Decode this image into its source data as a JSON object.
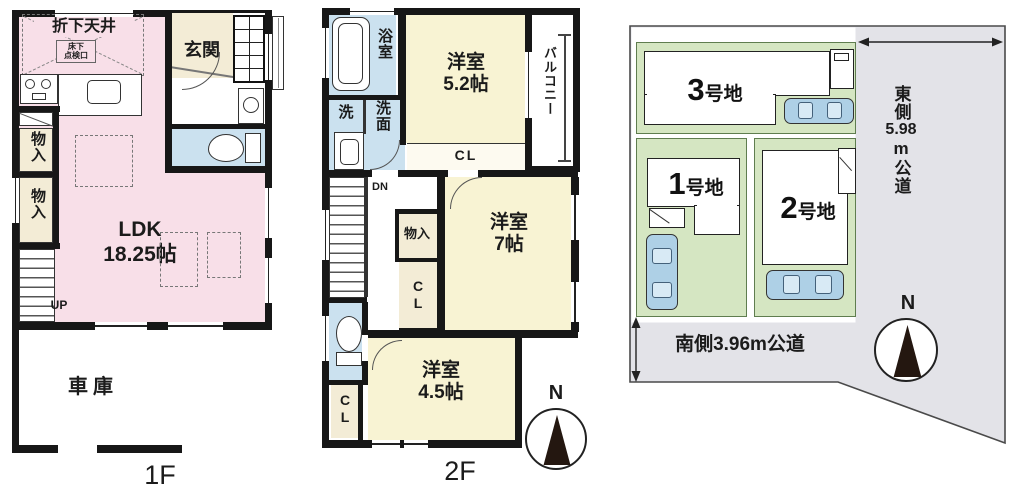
{
  "colors": {
    "wall": "#171717",
    "ldk_pink": "#f8dfe8",
    "room_yellow": "#f8f3d3",
    "wet_blue": "#cbe1ef",
    "closet_cream": "#f3ecd6",
    "lot_green": "#d5e6c2",
    "road_gray": "#e3e3e8",
    "car_blue": "#aed0e6"
  },
  "floor1": {
    "label": "1F",
    "ceiling_note": "折下天井",
    "access_hatch": "床下\n点検口",
    "entrance": "玄関",
    "storage_a": "物入",
    "storage_b": "物入",
    "ldk": "LDK\n18.25帖",
    "stairs_up": "UP",
    "garage": "車庫"
  },
  "floor2": {
    "label": "2F",
    "bath": "浴室",
    "laundry": "洗",
    "washroom": "洗面",
    "bedroom_52": "洋室\n5.2帖",
    "balcony": "バルコニー",
    "closet_top": "CL",
    "stairs_down": "DN",
    "storage": "物入",
    "closet_mid": "C\nL",
    "bedroom_7": "洋室\n7帖",
    "closet_bottom": "C\nL",
    "bedroom_45": "洋室\n4.5帖"
  },
  "siteplan": {
    "lot_1": "1号地",
    "lot_2": "2号地",
    "lot_3": "3号地",
    "east_road_parts": [
      "東側",
      "5.98",
      "m公道"
    ],
    "south_road": "南側3.96m公道"
  },
  "compass_2f": {
    "north": "N"
  },
  "compass_site": {
    "north": "N"
  }
}
